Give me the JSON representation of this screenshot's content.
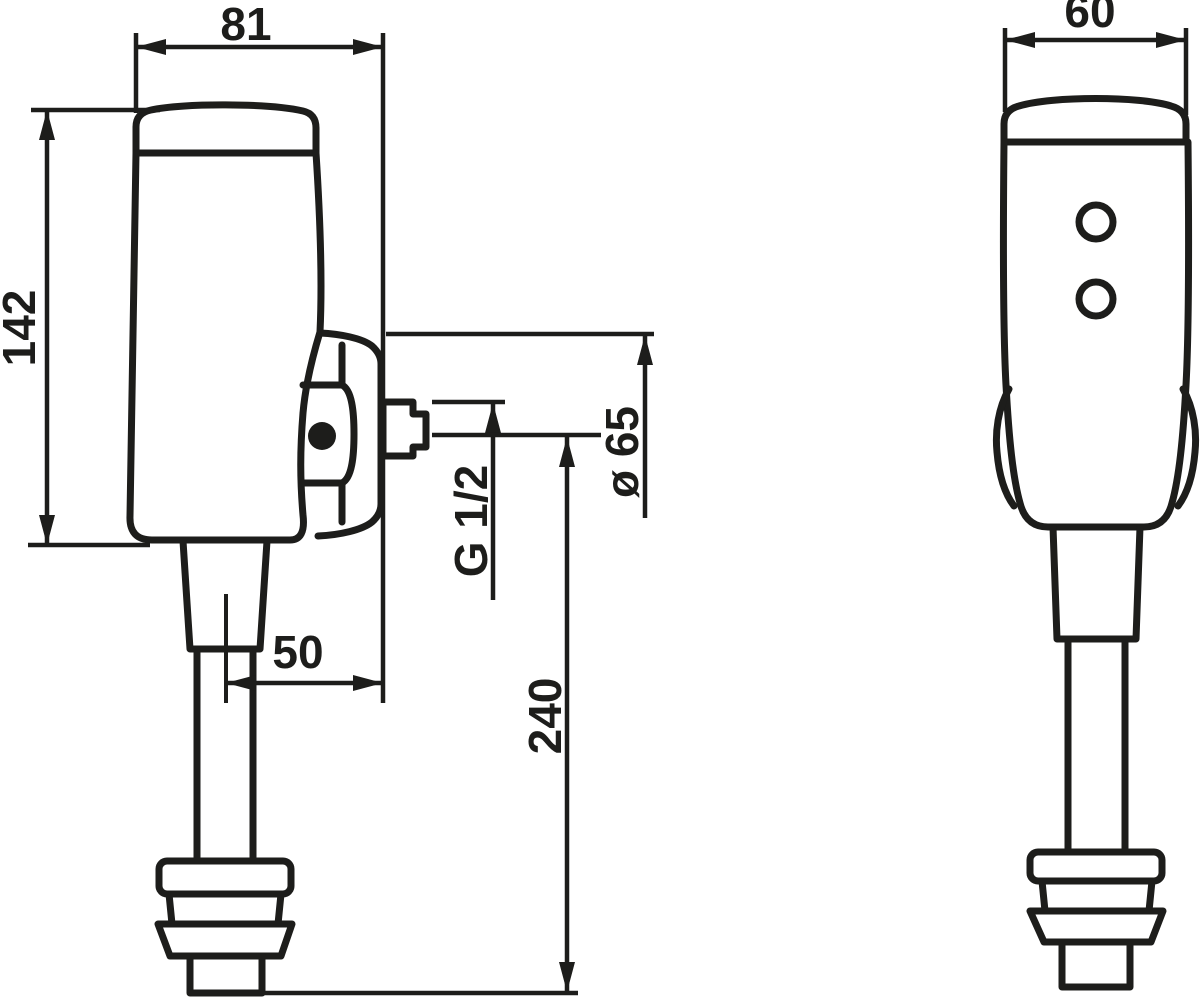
{
  "drawing": {
    "kind": "flush-valve-dimensional-drawing",
    "colors": {
      "line": "#1d1d1b",
      "background": "#ffffff"
    },
    "dimensions": {
      "body_width": {
        "label": "81"
      },
      "body_height": {
        "label": "142"
      },
      "pipe_axis_to_wall": {
        "label": "50"
      },
      "outlet_thread": {
        "label": "G 1/2"
      },
      "boss_diameter": {
        "label": "ø 65"
      },
      "outlet_height_above_floor": {
        "label": "240"
      },
      "front_width": {
        "label": "60"
      }
    }
  }
}
